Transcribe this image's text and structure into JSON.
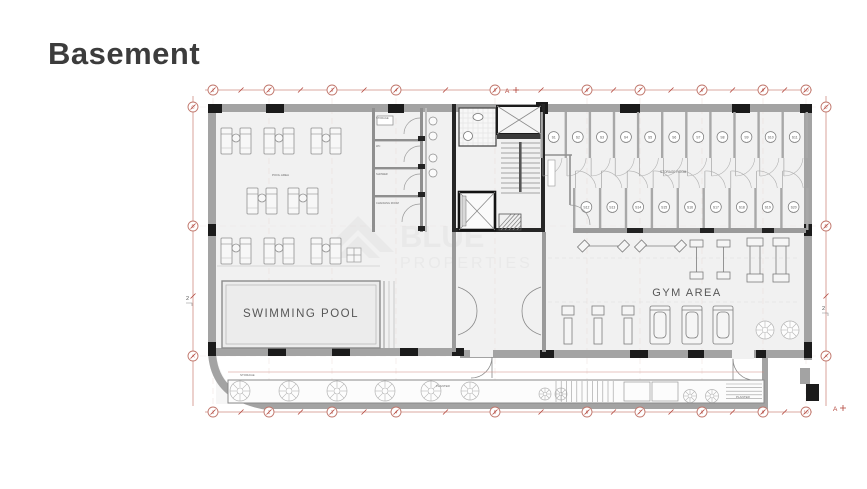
{
  "page": {
    "title": "Basement"
  },
  "watermark": {
    "brand_top": "BLUE",
    "brand_bottom": "PROPERTIES"
  },
  "plan": {
    "labels": {
      "swimming_pool": "SWIMMING POOL",
      "gym_area": "GYM AREA",
      "pool_area": "POOL AREA",
      "storage_room": "STORAGE ROOM",
      "storage_corner": "STORAGE",
      "room_storage": "STORAGE",
      "room_wc": "WC",
      "room_shower": "SHOWER",
      "room_changing": "CHANGING ROOM",
      "planter_left": "PLANTER",
      "planter_right": "PLANTER",
      "section_marker_top": "A",
      "section_marker_bottom": "A",
      "side_marker_left": "2",
      "side_marker_right": "2"
    },
    "grid": {
      "top": [
        "1",
        "2",
        "3",
        "4",
        "5",
        "6",
        "7",
        "8",
        "9",
        "10"
      ],
      "bottom": [
        "1",
        "2",
        "3",
        "4",
        "5",
        "6",
        "7",
        "8",
        "9",
        "10"
      ],
      "left": [
        "C",
        "B",
        "A"
      ],
      "right": [
        "C",
        "B",
        "A"
      ]
    },
    "storage_units": {
      "top_row": [
        "S1",
        "S2",
        "S3",
        "S4",
        "S5",
        "S6",
        "S7",
        "S8",
        "S9",
        "S10",
        "S11"
      ],
      "bottom_row": [
        "S12",
        "S13",
        "S14",
        "S15",
        "S16",
        "S17",
        "S18",
        "S19",
        "S20"
      ]
    },
    "colors": {
      "wall": "#a3a3a3",
      "column": "#1b1b1b",
      "dimension": "#c0766b",
      "floor": "#f1f1f1",
      "watermark": "#e9e9e9",
      "title": "#3c3c3c"
    }
  }
}
